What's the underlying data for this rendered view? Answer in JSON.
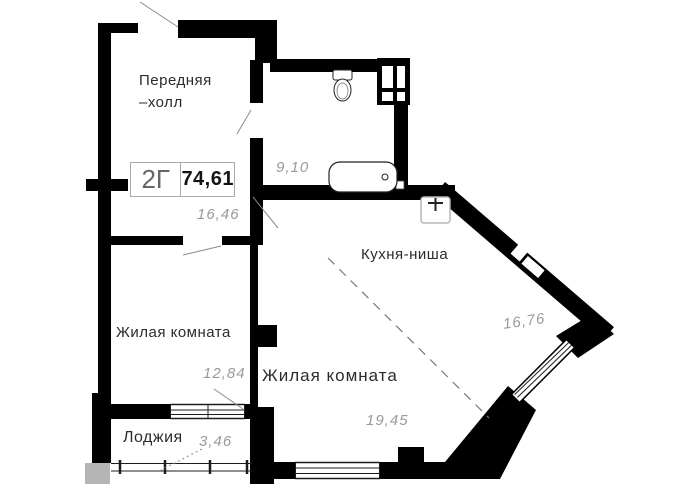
{
  "stamp": {
    "unit": "2Г",
    "total_area": "74,61"
  },
  "rooms": {
    "hall": {
      "name_line1": "Передняя",
      "name_line2": "–холл",
      "area": "16,46"
    },
    "bathroom": {
      "area": "9,10"
    },
    "kitchen_niche": {
      "name": "Кухня-ниша",
      "area": "16,76"
    },
    "living_room_left": {
      "name": "Жилая комната",
      "area": "12,84"
    },
    "living_room_main": {
      "name": "Жилая комната",
      "area": "19,45"
    },
    "loggia": {
      "name": "Лоджия",
      "area": "3,46"
    }
  },
  "fixtures": {
    "toilet": "toilet-icon",
    "bathtub": "bathtub-icon",
    "sink": "sink-icon",
    "shaft": "ventilation-shaft-icon"
  },
  "colors": {
    "wall": "#000000",
    "room_label": "#2b2b2b",
    "area_label": "#9a9a9a",
    "line": "#8a8a8a",
    "slab": "#b5b5b5"
  }
}
